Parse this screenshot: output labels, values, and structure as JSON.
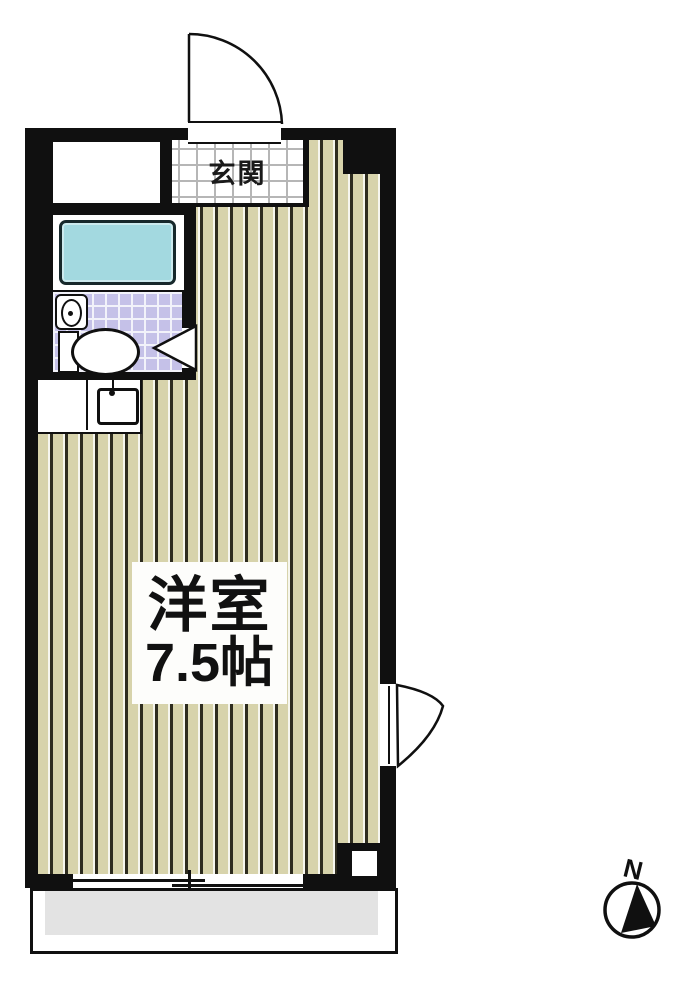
{
  "plan": {
    "title": "apartment-floorplan",
    "entrance": {
      "label": "玄関"
    },
    "main_room": {
      "name": "洋室",
      "size": "7.5帖"
    },
    "compass": {
      "label": "N"
    },
    "fixtures": [
      "entrance-door",
      "closet",
      "bathtub",
      "corner-sink",
      "toilet",
      "kitchen-sink",
      "swing-door",
      "sliding-window",
      "balcony"
    ],
    "colors": {
      "wall": "#101010",
      "floor_plank": "#d7d3ab",
      "floor_line_dark": "#2e2c1f",
      "bathtub_fill": "#a3d9e0",
      "toilet_tile": "#c5c1e8",
      "genkan_grout": "#b6b6b6",
      "balcony_fill": "#e3e3e3"
    }
  }
}
